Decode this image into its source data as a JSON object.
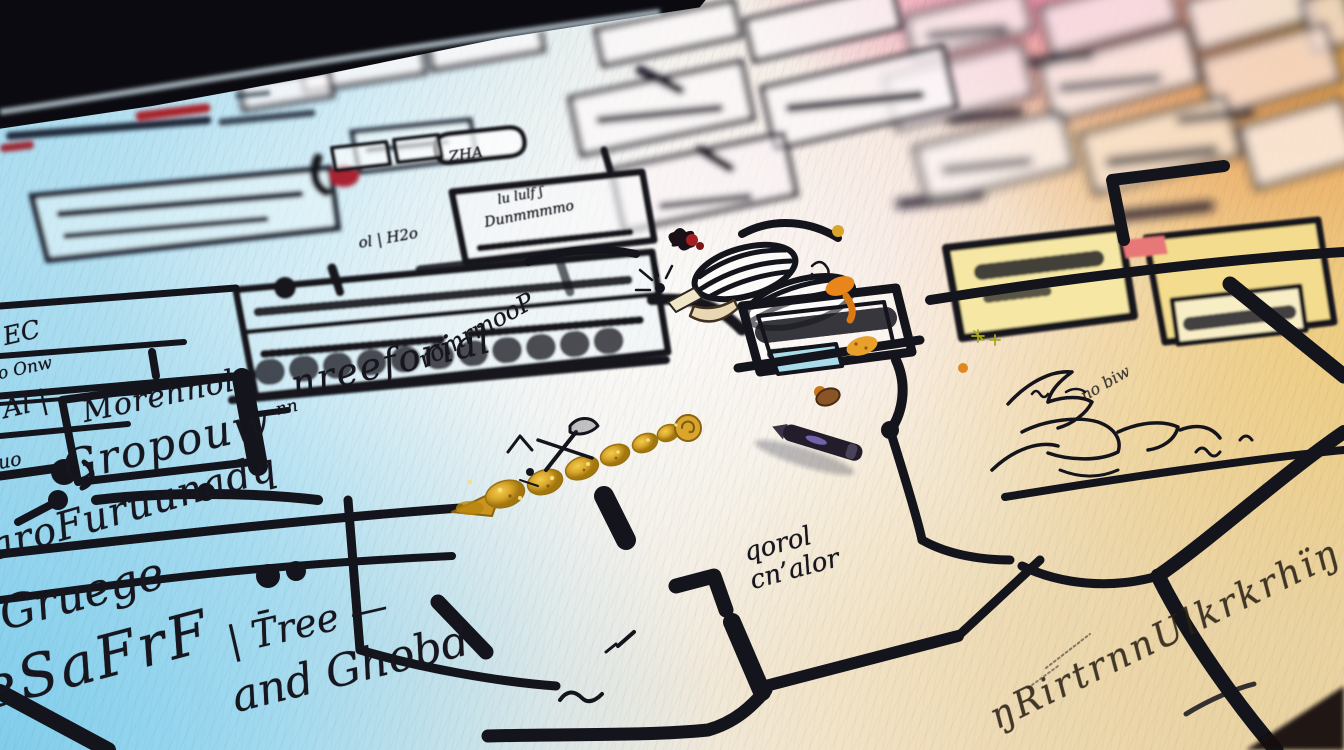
{
  "scene": {
    "description": "Photograph-style image of a hand-drawn flowchart sketched in black marker on paper, viewed in steep perspective with shallow depth of field. Rainbow light washes the sheet: cyan-blue lower left, white center, pink upper right, orange-yellow and green at the right edge. A dark marker pen lies on the sheet, a gold glitter arrow and a small gadget doodle with coiled springs sit mid-frame, and large illegible handwritten words fill the foreground.",
    "labels": {
      "morehnol": "Morehnol",
      "gropouw": "Gropouw",
      "furuunada": "aroFuruunadq",
      "gruege": "Gruege",
      "tree": "| T̄ree —",
      "esafrf": "eSaFrF",
      "ghobd": "and Ghobd",
      "qorol_line1": "qorol",
      "qorol_line2": "cn’alor",
      "nreeforial": "nreeforial",
      "romrmop": "romrmooP",
      "h2o": "ol | H2o",
      "ec": "EC",
      "onw": "o Onw",
      "al": "Al |",
      "uo": "uo",
      "nn": "nn",
      "zha": "ZHA",
      "lululf": "lu lulf ʃ",
      "dunmmm": "Dunmmmmo",
      "pirtn": "ŋRirtrnnUlkrkrhïŋ",
      "nobiw": "no biw"
    },
    "palette": {
      "ink": "#17161e",
      "paper_blue": "#a9dcf0",
      "paper_white": "#f2efe8",
      "paper_cream": "#ecd9b5",
      "pink": "#ee82ac",
      "orange": "#ee9440",
      "yellow": "#f3d98a",
      "green": "#78ba2e",
      "red": "#a8242c",
      "gold": "#d9a62b",
      "pen_body": "#231d2b",
      "pen_highlight": "#7f6fc5"
    }
  }
}
